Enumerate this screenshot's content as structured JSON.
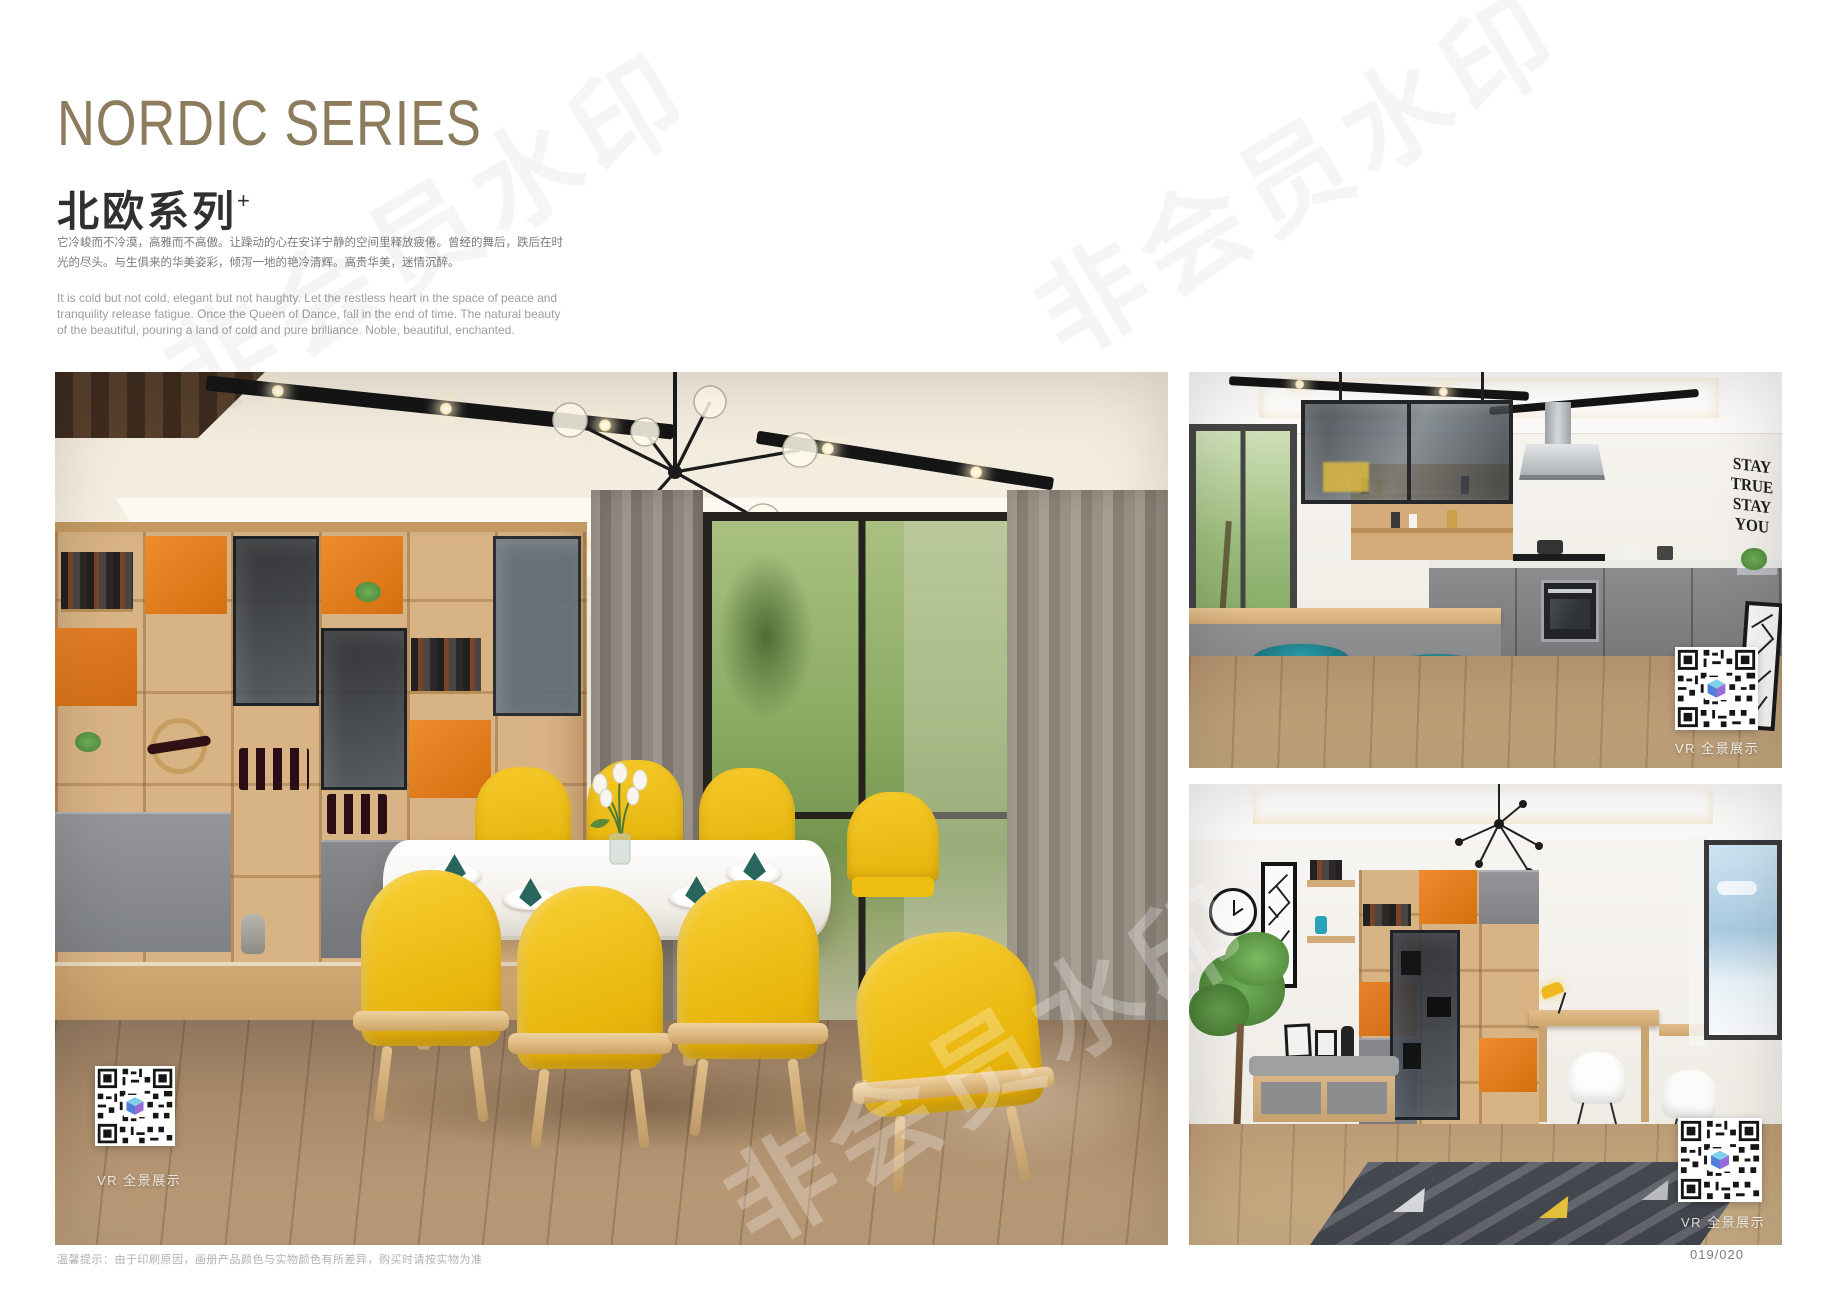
{
  "header": {
    "title": "NORDIC SERIES",
    "subtitle": "北欧系列",
    "subtitle_sup": "+",
    "paragraph_cn": "它冷峻而不冷漠，高雅而不高傲。让躁动的心在安详宁静的空间里释放疲倦。曾经的舞后，跌后在时光的尽头。与生俱来的华美姿彩，倾泻一地的艳冷清辉。高贵华美，迷情沉醉。",
    "paragraph_en": "It is cold but not cold, elegant but not haughty. Let the restless heart in the space of peace and tranquility release fatigue. Once the Queen of Dance, fall in the end of time. The natural beauty of the beautiful, pouring a land of cold and pure brilliance. Noble, beautiful, enchanted."
  },
  "vr_label": "VR 全景展示",
  "watermark": {
    "text": "非会员水印"
  },
  "kitchen": {
    "wall_art": [
      "STAY",
      "TRUE",
      "STAY",
      "YOU"
    ]
  },
  "footer": {
    "note": "温馨提示：由于印刷原因，画册产品颜色与实物颜色有所差异，购买时请按实物为准",
    "page_number": "019/020"
  },
  "colors": {
    "title_gold": "#8d7b5e",
    "accent_orange": "#e0761f",
    "chair_yellow": "#f2c41a",
    "stool_teal": "#1f808d",
    "wood": "#d8b383",
    "napkin_teal": "#27655d"
  }
}
